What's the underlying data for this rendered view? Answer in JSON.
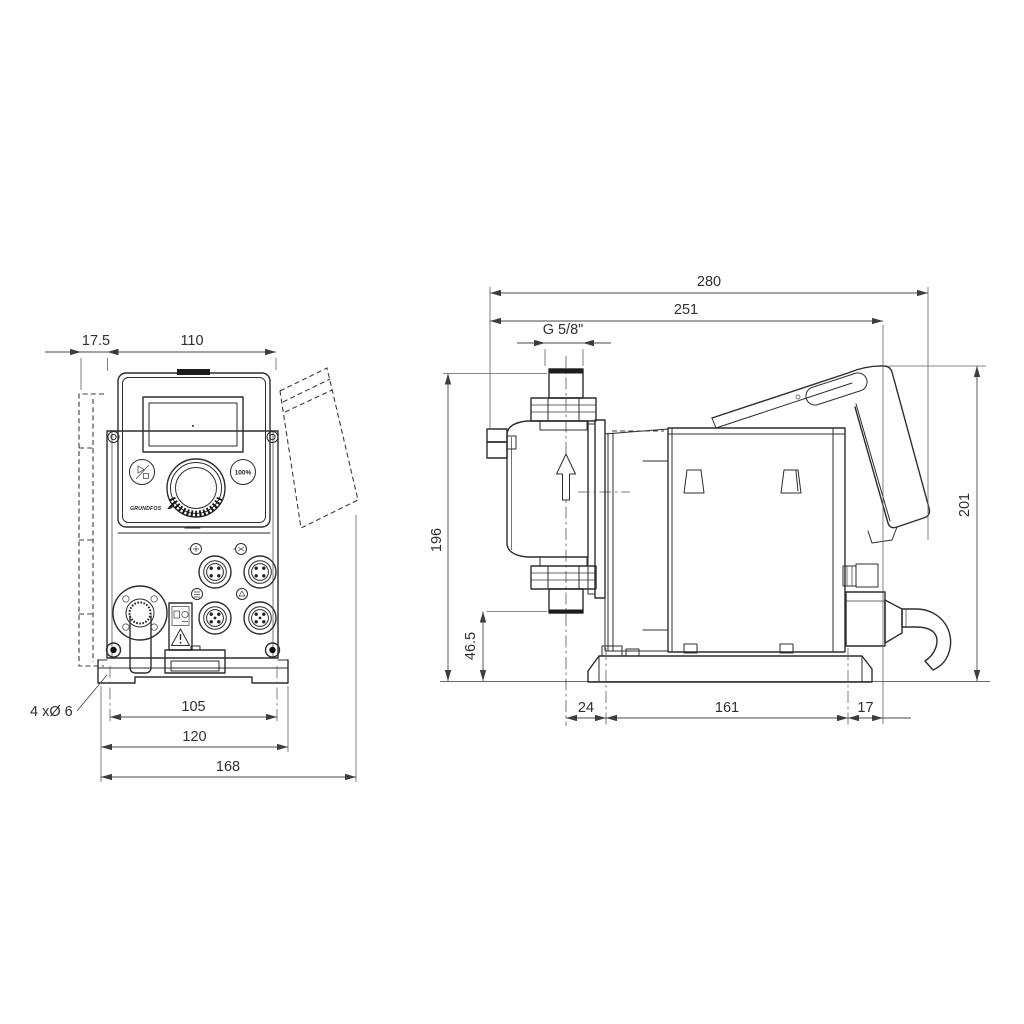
{
  "front_view": {
    "dim_wall_offset": "17.5",
    "dim_width": "110",
    "dim_hole_spacing": "105",
    "dim_plate_width": "120",
    "dim_total_width": "168",
    "label_mounting_holes": "4 xØ 6",
    "button_100": "100%",
    "brand": "GRUNDFOS"
  },
  "side_view": {
    "dim_total_depth": "280",
    "dim_depth_to_plate": "251",
    "label_thread": "G 5/8\"",
    "dim_height": "196",
    "dim_valve_height": "46.5",
    "dim_rear_height": "201",
    "dim_front_offset": "24",
    "dim_foot_length": "161",
    "dim_rear_offset": "17"
  }
}
